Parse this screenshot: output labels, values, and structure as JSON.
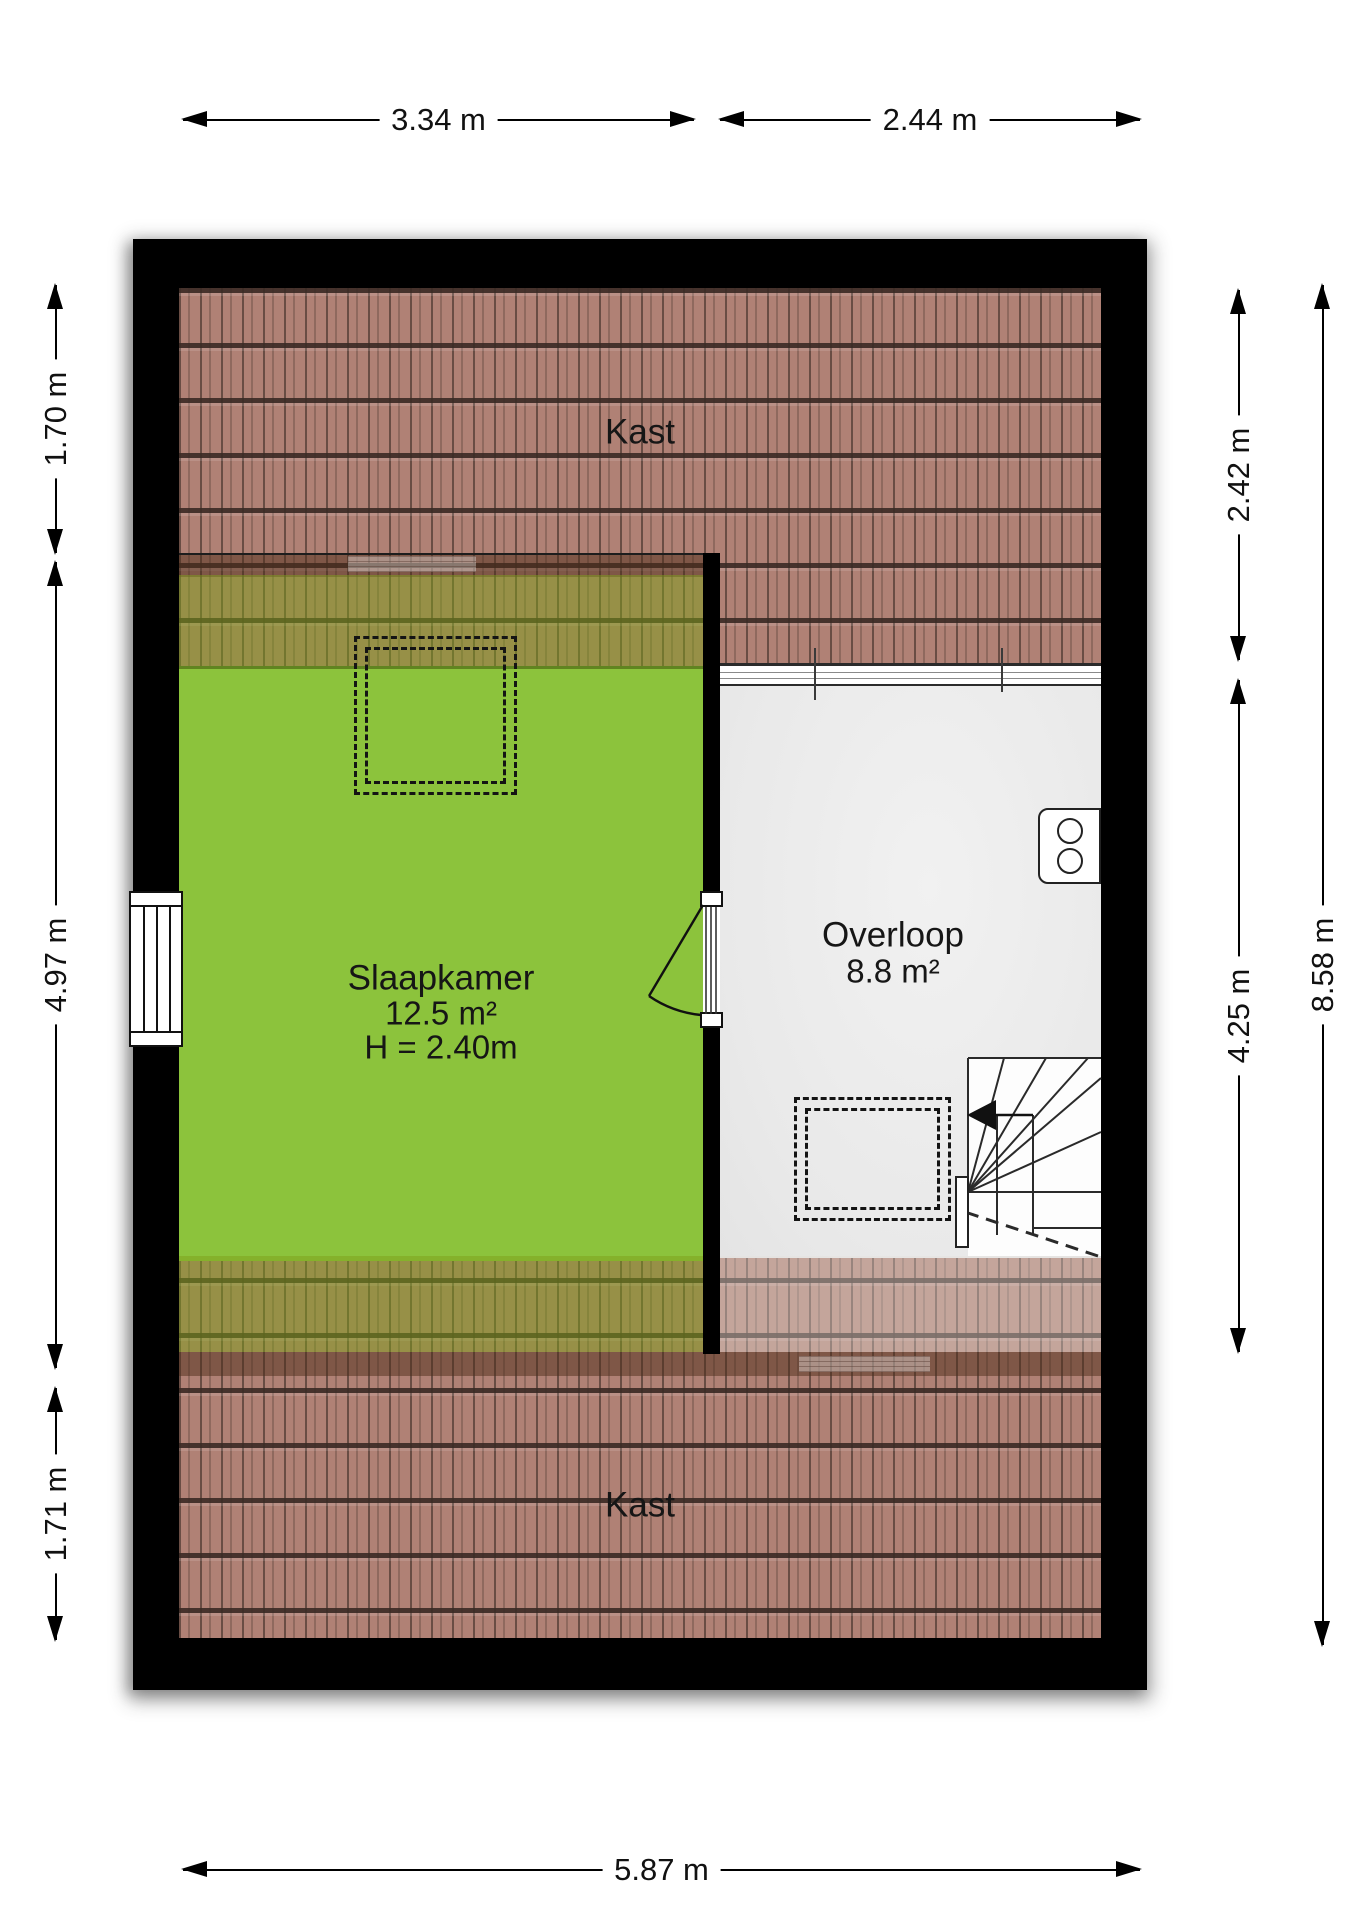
{
  "plan": {
    "rooms": {
      "kast_top": "Kast",
      "kast_bottom": "Kast",
      "slaapkamer_name": "Slaapkamer",
      "slaapkamer_area": "12.5 m²",
      "slaapkamer_height": "H = 2.40m",
      "overloop_name": "Overloop",
      "overloop_area": "8.8 m²"
    },
    "dimensions": {
      "top_left": "3.34 m",
      "top_right": "2.44 m",
      "left_top": "1.70 m",
      "left_middle": "4.97 m",
      "left_bottom": "1.71 m",
      "right_top": "2.42 m",
      "right_middle": "4.25 m",
      "right_overall": "8.58 m",
      "bottom": "5.87 m"
    },
    "colors": {
      "wall": "#000000",
      "bedroom_floor": "#8cc33c",
      "landing_floor": "#ececec",
      "roof_tile": "#b08175",
      "background": "#ffffff"
    }
  }
}
